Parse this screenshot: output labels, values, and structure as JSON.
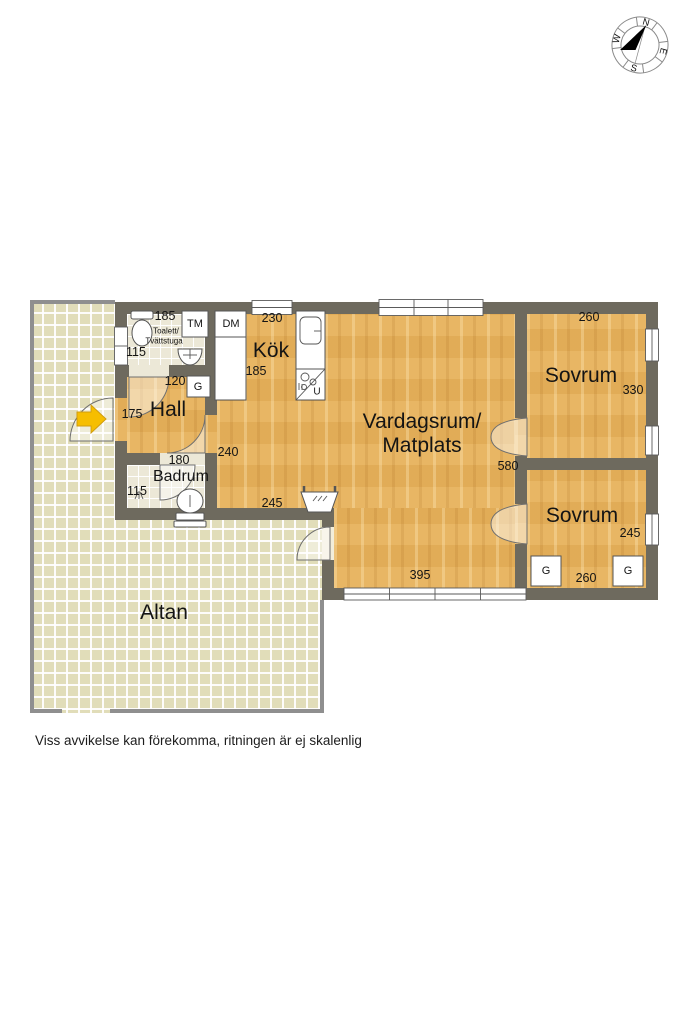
{
  "plan": {
    "disclaimer": "Viss avvikelse kan förekomma, ritningen är ej skalenlig",
    "compass": {
      "north": "N",
      "west": "W",
      "south": "S",
      "east": "E"
    },
    "colors": {
      "wall": "#6e6a5e",
      "wood_floor": "#e7b25c",
      "bath_tile": "#ece8d7",
      "altan_tile": "#e1ddb9",
      "entrance_arrow": "#f6be00"
    },
    "rooms": {
      "toalett": {
        "name_line1": "Toalett/",
        "name_line2": "Tvättstuga",
        "width": "185",
        "depth": "115"
      },
      "kok": {
        "name": "Kök",
        "width": "230",
        "depth": "185"
      },
      "hall": {
        "name": "Hall",
        "width": "120",
        "depth": "175"
      },
      "badrum": {
        "name": "Badrum",
        "width": "180",
        "depth": "115"
      },
      "vardagsrum": {
        "name_line1": "Vardagsrum/",
        "name_line2": "Matplats",
        "width_upper": "240",
        "width_lower": "245",
        "depth": "580",
        "window_width": "395"
      },
      "sovrum1": {
        "name": "Sovrum",
        "width": "260",
        "depth": "330"
      },
      "sovrum2": {
        "name": "Sovrum",
        "width": "260",
        "depth": "245"
      },
      "altan": {
        "name": "Altan"
      }
    },
    "appliances": {
      "washing_machine": "TM",
      "dishwasher": "DM",
      "wardrobe": "G",
      "oven": "U"
    }
  }
}
